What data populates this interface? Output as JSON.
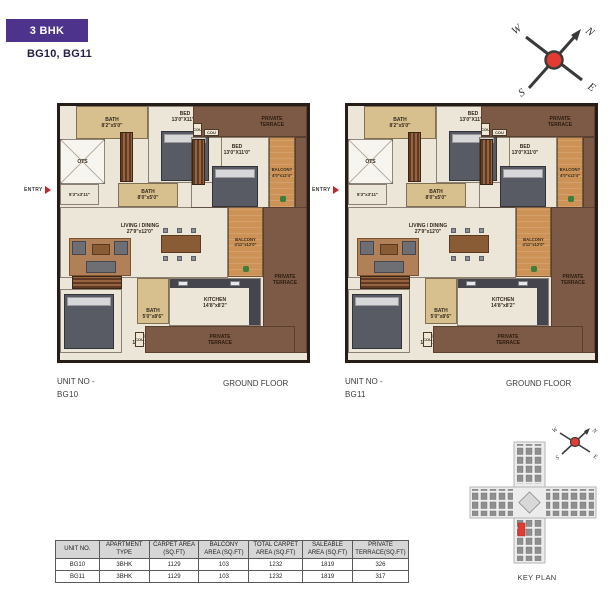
{
  "page": {
    "badge": "3 BHK",
    "subtitle": "BG10, BG11"
  },
  "compass": {
    "n": "N",
    "e": "E",
    "s": "S",
    "w": "W"
  },
  "plan": {
    "entry_label": "ENTRY",
    "entry_dims": "5'3\"x3'11\"",
    "ots": "OTS",
    "cou": "COU",
    "bath1": {
      "name": "BATH",
      "dims": "8'2\"x5'0\""
    },
    "bed1": {
      "name": "BED",
      "dims": "13'0\"X11'1\""
    },
    "terrace_top": {
      "label": "PRIVATE TERRACE"
    },
    "bed2": {
      "name": "BED",
      "dims": "13'0\"X11'0\""
    },
    "balcony1": {
      "name": "BALCONY",
      "dims": "4'0\"x12'4\""
    },
    "bath2": {
      "name": "BATH",
      "dims": "8'0\"x5'0\""
    },
    "living": {
      "name": "LIVING / DINING",
      "dims": "27'9\"x12'0\""
    },
    "balcony2": {
      "name": "BALCONY",
      "dims": "4'11\"x12'0\""
    },
    "terrace_right": {
      "label": "PRIVATE TERRACE"
    },
    "bed3": {
      "name": "BED",
      "dims": "12'0\"X13'6\""
    },
    "bath3": {
      "name": "BATH",
      "dims": "5'0\"x8'6\""
    },
    "kitchen": {
      "name": "KITCHEN",
      "dims": "14'8\"x8'2\""
    },
    "terrace_bottom": {
      "label": "PRIVATE TERRACE"
    }
  },
  "units": [
    {
      "unit_label": "UNIT NO -",
      "unit_no": "BG10",
      "floor_label": "GROUND FLOOR"
    },
    {
      "unit_label": "UNIT NO -",
      "unit_no": "BG11",
      "floor_label": "GROUND FLOOR"
    }
  ],
  "key_plan": {
    "caption": "KEY PLAN"
  },
  "table": {
    "headers": [
      "UNIT NO.",
      "APARTMENT TYPE",
      "CARPET AREA (SQ.FT)",
      "BALCONY AREA (SQ.FT)",
      "TOTAL CARPET AREA (SQ.FT)",
      "SALEABLE AREA (SQ.FT)",
      "PRIVATE TERRACE(SQ.FT)"
    ],
    "rows": [
      [
        "BG10",
        "3BHK",
        "1129",
        "103",
        "1232",
        "1819",
        "326"
      ],
      [
        "BG11",
        "3BHK",
        "1129",
        "103",
        "1232",
        "1819",
        "317"
      ]
    ]
  },
  "colors": {
    "accent_purple": "#4e338c",
    "compass_red": "#e23b33",
    "terrace_brown": "#7d5a45",
    "balcony_orange": "#cd9356",
    "bath_tan": "#d8bf8e",
    "floor_cream": "#ece6d8",
    "keyplan_unit_red": "#e23b33",
    "table_header_gray": "#d6d6d6"
  }
}
